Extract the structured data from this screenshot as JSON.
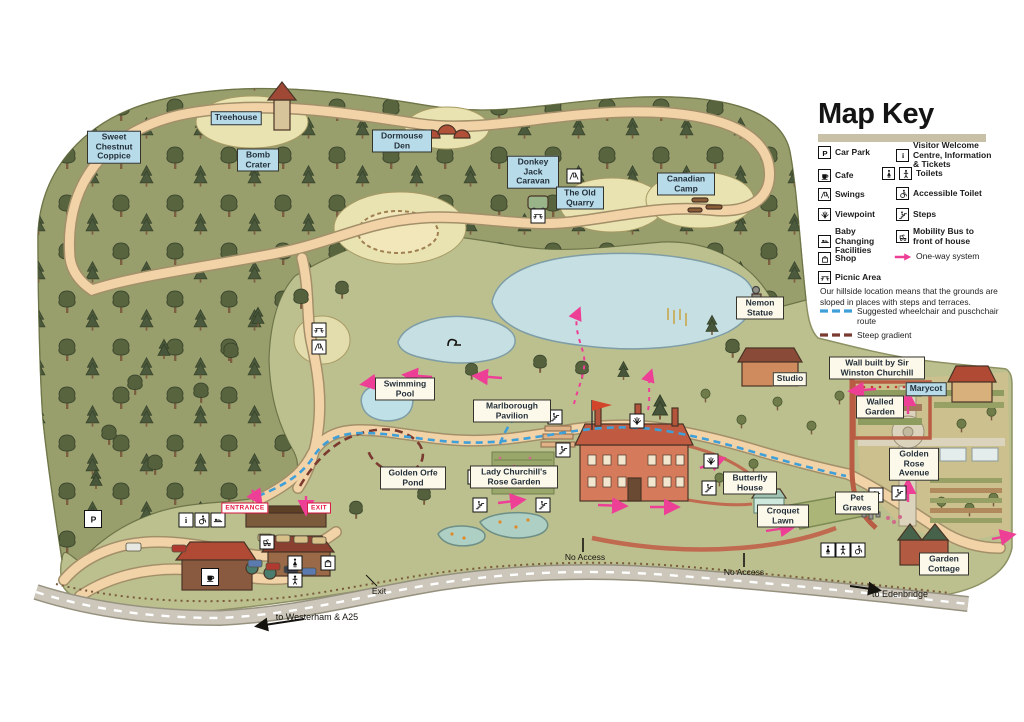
{
  "map_key": {
    "title": "Map Key",
    "left_items": [
      {
        "icon": "car-park-icon",
        "label": "Car Park"
      },
      {
        "icon": "cafe-icon",
        "label": "Cafe"
      },
      {
        "icon": "swings-icon",
        "label": "Swings"
      },
      {
        "icon": "viewpoint-icon",
        "label": "Viewpoint"
      },
      {
        "icon": "baby-changing-icon",
        "label": "Baby Changing Facilities"
      },
      {
        "icon": "shop-icon",
        "label": "Shop"
      },
      {
        "icon": "picnic-area-icon",
        "label": "Picnic Area"
      }
    ],
    "right_items": [
      {
        "icon": "info-icon",
        "label": "Visitor Welcome Centre, Information & Tickets"
      },
      {
        "icon": "toilets-icon",
        "label": "Toilets"
      },
      {
        "icon": "accessible-toilet-icon",
        "label": "Accessible Toilet"
      },
      {
        "icon": "steps-icon",
        "label": "Steps"
      },
      {
        "icon": "mobility-bus-icon",
        "label": "Mobility Bus to front of house"
      },
      {
        "icon": "one-way-icon",
        "label": "One-way system"
      }
    ],
    "note": "Our hillside location means that the grounds are sloped in places with steps and terraces.",
    "route_legend": [
      {
        "label": "Suggested wheelchair and puschchair route",
        "color": "#3f9fd8"
      },
      {
        "label": "Steep gradient",
        "color": "#7a3a30"
      }
    ]
  },
  "places": {
    "sweet_chestnut_coppice": "Sweet Chestnut Coppice",
    "treehouse": "Treehouse",
    "bomb_crater": "Bomb Crater",
    "dormouse_den": "Dormouse Den",
    "donkey_jack_caravan": "Donkey Jack Caravan",
    "the_old_quarry": "The Old Quarry",
    "canadian_camp": "Canadian Camp",
    "nemon_statue": "Nemon Statue",
    "studio": "Studio",
    "churchill_wall": "Wall built by Sir Winston Churchill",
    "marycot": "Marycot",
    "walled_garden": "Walled Garden",
    "golden_rose_avenue": "Golden Rose Avenue",
    "swimming_pool": "Swimming Pool",
    "marlborough_pavilion": "Marlborough Pavilion",
    "golden_orfe_pond": "Golden Orfe Pond",
    "lady_churchills_rose_garden": "Lady Churchill's Rose Garden",
    "butterfly_house": "Butterfly House",
    "croquet_lawn": "Croquet Lawn",
    "pet_graves": "Pet Graves",
    "garden_cottage": "Garden Cottage"
  },
  "signs": {
    "entrance": "ENTRANCE",
    "exit": "EXIT",
    "exit_road": "Exit",
    "no_access": "No Access",
    "to_westerham": "to Westerham & A25",
    "to_edenbridge": "to Edenbridge"
  },
  "colors": {
    "label_blue": "#b7dbe9",
    "label_cream": "#fcf8ea",
    "sign_red": "#e5173f",
    "one_way_pink": "#ee3f96",
    "wheelchair_route_blue": "#3f9fd8",
    "steep_gradient_red": "#7a3a30",
    "key_bar_tan": "#c9c0a8"
  },
  "icons": {
    "car_park_letter": "P",
    "info_letter": "i"
  }
}
